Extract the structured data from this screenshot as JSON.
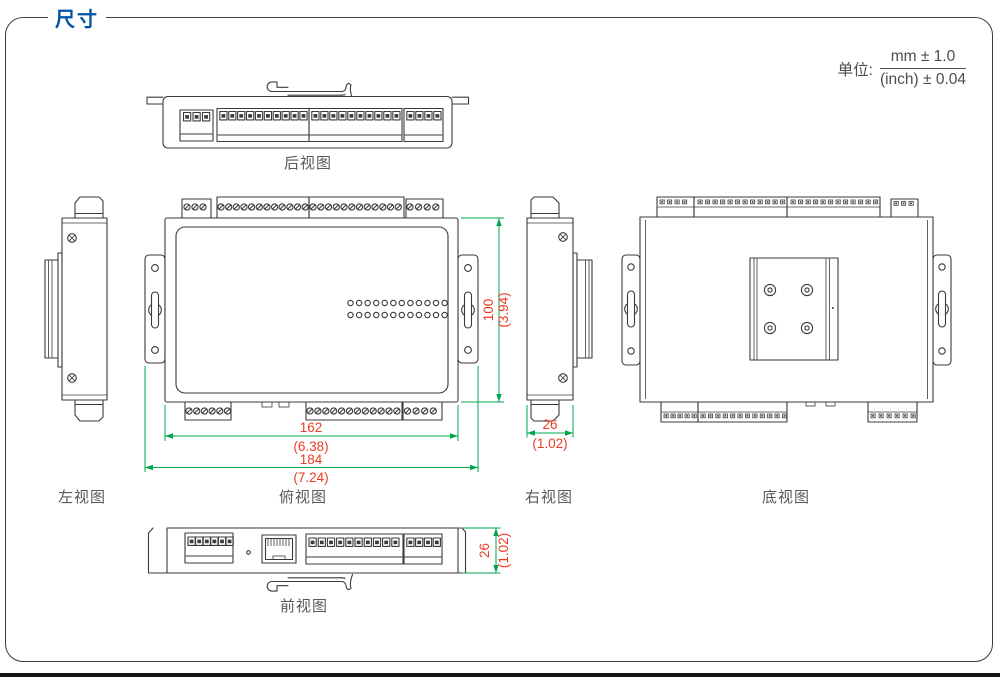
{
  "page": {
    "title": "尺寸",
    "unit": {
      "label": "单位:",
      "numerator": "mm ± 1.0",
      "denominator": "(inch) ± 0.04"
    }
  },
  "views": {
    "rear": {
      "label": "后视图"
    },
    "left": {
      "label": "左视图"
    },
    "top": {
      "label": "俯视图"
    },
    "right": {
      "label": "右视图"
    },
    "bottom": {
      "label": "底视图"
    },
    "front": {
      "label": "前视图"
    }
  },
  "dimensions": {
    "width_inner": {
      "mm": "162",
      "inch": "(6.38)"
    },
    "width_outer": {
      "mm": "184",
      "inch": "(7.24)"
    },
    "height_body": {
      "mm": "100",
      "inch": "(3.94)"
    },
    "depth_right": {
      "mm": "26",
      "inch": "(1.02)"
    },
    "depth_front": {
      "mm": "26",
      "inch": "(1.02)"
    }
  },
  "colors": {
    "accent_blue": "#0054A6",
    "dimension_line_green": "#00A44F",
    "dimension_text_red": "#EE3B24",
    "drawing_line": "#3B3B3B",
    "label_gray": "#58595B"
  }
}
